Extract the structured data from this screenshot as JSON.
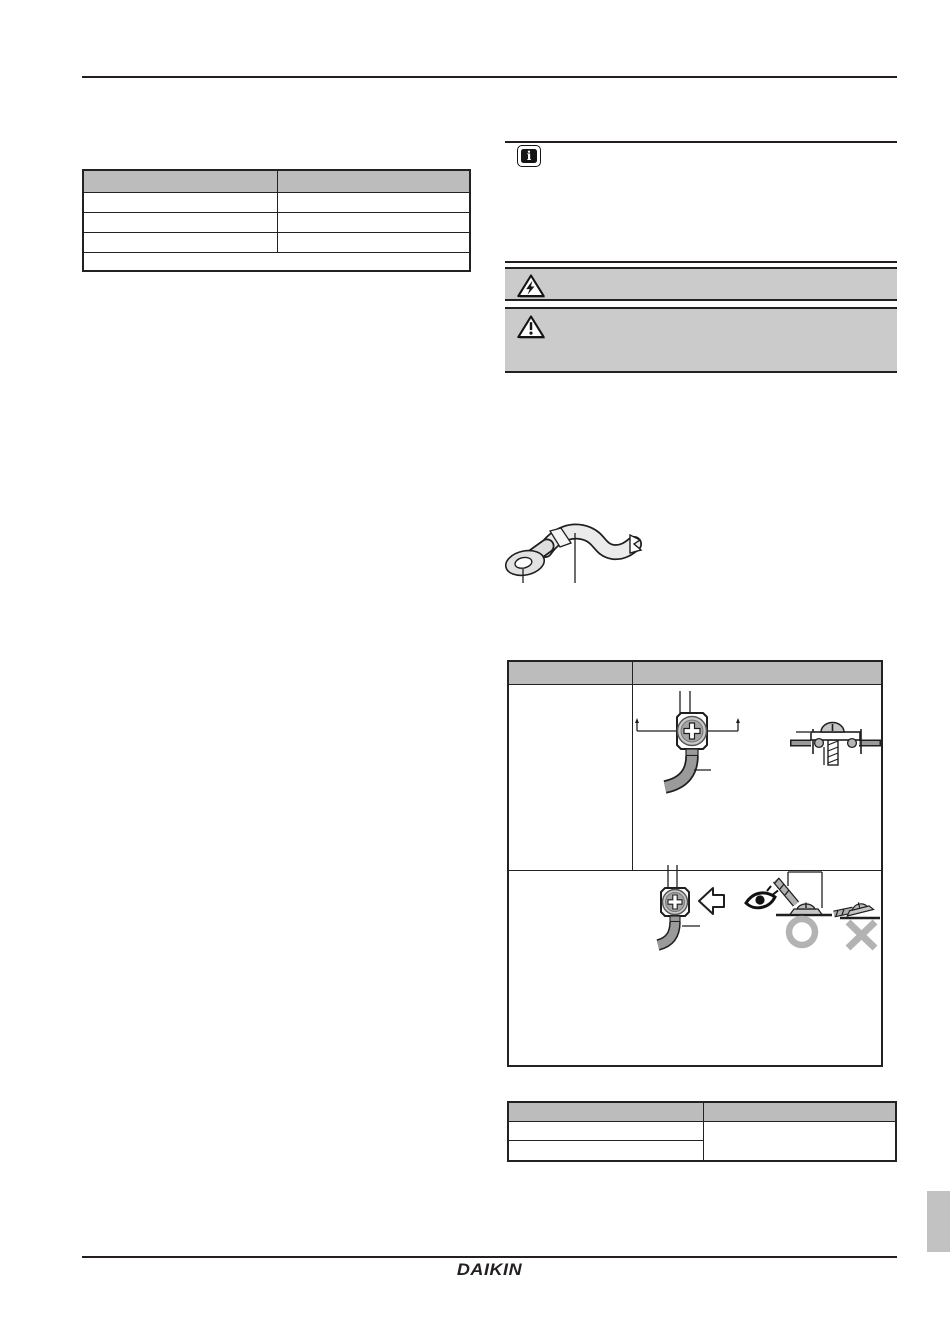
{
  "document": {
    "type": "installation-manual-page",
    "background": "#ffffff",
    "rule_color": "#231f20"
  },
  "left_table": {
    "header_bg": "#bcbcbc",
    "columns": [
      "",
      ""
    ],
    "rows": [
      [
        "",
        ""
      ],
      [
        "",
        ""
      ],
      [
        "",
        ""
      ],
      [
        "",
        ""
      ]
    ]
  },
  "info_note": {
    "icon": "info-icon",
    "glyph": "i"
  },
  "warning_banners": [
    {
      "icon": "electric-hazard-warning-icon",
      "bg": "#cbcbcb"
    },
    {
      "icon": "general-warning-icon",
      "bg": "#cbcbcb"
    }
  ],
  "figures": {
    "wire_figure": "round-crimp-style-terminal-with-wire",
    "row1_front_figure": "terminal-screw-front-view",
    "row1_side_figure": "terminal-screw-with-cup-washer-side-view",
    "row2_figure": "terminal-orientation-correct-vs-incorrect",
    "ok_mark_color": "#b3b3b3",
    "x_mark_color": "#b3b3b3"
  },
  "terminal_table": {
    "header_bg": "#bcbcbc",
    "columns": [
      "",
      ""
    ],
    "rows": [
      [
        "",
        ""
      ],
      [
        "",
        ""
      ]
    ]
  },
  "bottom_table": {
    "header_bg": "#bcbcbc",
    "columns": [
      "",
      ""
    ],
    "left_rows": [
      "",
      ""
    ],
    "right_cell": ""
  },
  "side_tab": {
    "bg": "#c2c2c2"
  },
  "footer": {
    "logo_text": "DAIKIN"
  }
}
